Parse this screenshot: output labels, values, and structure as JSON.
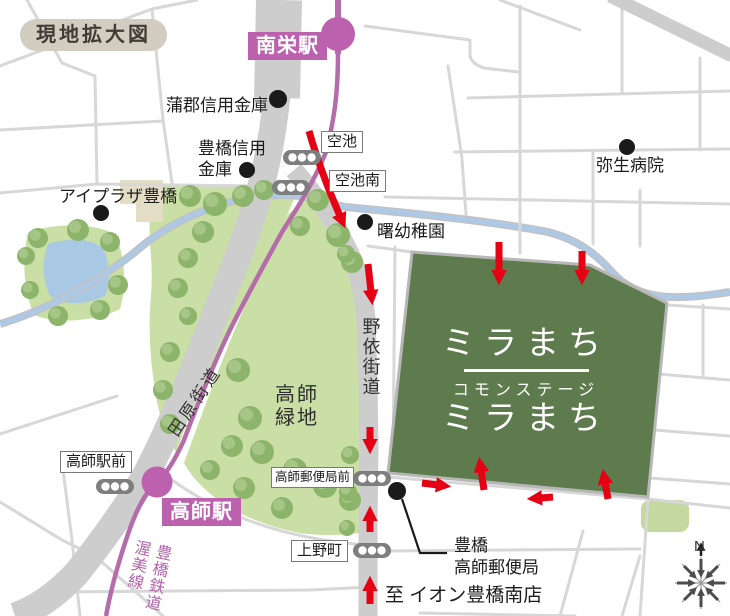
{
  "legend": {
    "title": "現地拡大図"
  },
  "stations": {
    "minamisakae": {
      "label": "南栄駅"
    },
    "takashi": {
      "label": "高師駅"
    }
  },
  "railway_label": "豊橋鉄道\n渥美線",
  "bus_stops": {
    "karaike": "空池",
    "karaike_minami": "空池南",
    "takashi_ekimae": "高師駅前",
    "takashi_post_office_mae": "高師郵便局前",
    "uenocho": "上野町"
  },
  "pois": {
    "gamagori_shinkin_bank": "蒲郡信用金庫",
    "toyohashi_shinkin_bank": "豊橋信用\n金庫",
    "ai_plaza_toyohashi": "アイプラザ豊橋",
    "yayoi_hospital": "弥生病院",
    "akebono_kindergarten": "曙幼稚園",
    "toyohashi_takashi_post_office": "豊橋\n高師郵便局"
  },
  "roads": {
    "tahara_kaido": "田原街道",
    "noyori_kaido": "野依街道"
  },
  "parks": {
    "takashi_ryokuchi": "高師\n緑地"
  },
  "site": {
    "name": "ミラまち",
    "brand": "コモンステージ",
    "name2": "ミラまち"
  },
  "notes": {
    "to_aeon": "至 イオン豊橋南店"
  },
  "compass": {
    "north": "N"
  },
  "colors": {
    "site_green": "#5d7b4d",
    "park_green": "#cadfa5",
    "tree_green": "#8cb46a",
    "rail_purple": "#b46cab",
    "station_purple": "#bc61ae",
    "arrow_red": "#e60013",
    "river_blue": "#adc9e5",
    "road_gray": "#cdcdcd",
    "pond_blue": "#a9c8e4"
  }
}
